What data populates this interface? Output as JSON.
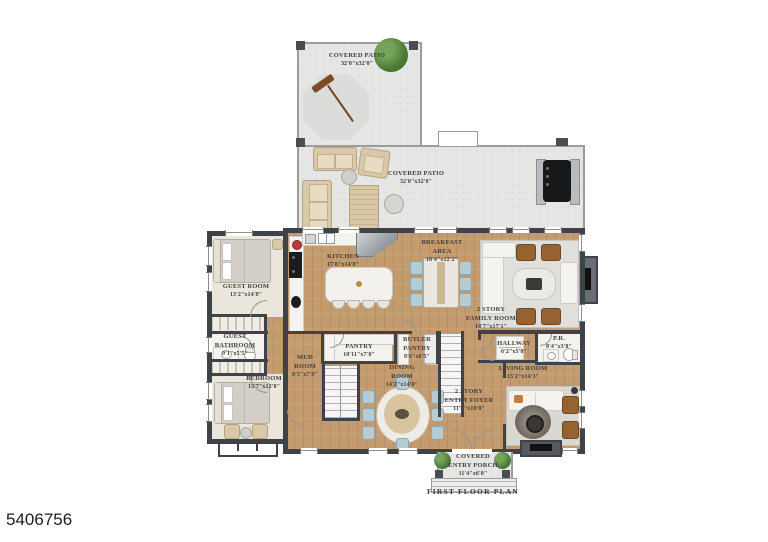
{
  "page": {
    "listing_id": "5406756",
    "caption": "FIRST FLOOR PLAN"
  },
  "colors": {
    "wall": "#3f4347",
    "wood_floor": "#c49b6e",
    "patio_concrete": "#e6e6e4",
    "plant_green": "#4e7b38"
  },
  "rooms": {
    "patio_upper": {
      "name": "COVERED PATIO",
      "dims": "32'0\"x32'0\""
    },
    "patio_lower": {
      "name": "COVERED PATIO",
      "dims": "32'0\"x32'0\""
    },
    "kitchen": {
      "name": "KITCHEN",
      "dims": "17'8\"x14'8\""
    },
    "breakfast": {
      "name": "BREAKFAST AREA",
      "dims": "18'4\"x12'2\""
    },
    "family": {
      "name": "2 STORY\nFAMILY ROOM",
      "dims": "14'7\"x17'1\""
    },
    "guest_room": {
      "name": "GUEST ROOM",
      "dims": "13'2\"x14'8\""
    },
    "guest_bath": {
      "name": "GUEST\nBATHROOM",
      "dims": "9'1\"x5'5\""
    },
    "bedroom": {
      "name": "BEDROOM",
      "dims": "13'7\"x12'8\""
    },
    "mud_room": {
      "name": "MUD ROOM",
      "dims": "8'5\"x7'9\""
    },
    "pantry": {
      "name": "PANTRY",
      "dims": "10'11\"x7'0\""
    },
    "butler": {
      "name": "BUTLER\nPANTRY",
      "dims": "8'6\"x6'5\""
    },
    "dining": {
      "name": "DINING ROOM",
      "dims": "14'2\"x14'0\""
    },
    "hallway": {
      "name": "HALLWAY",
      "dims": "6'2\"x5'8\""
    },
    "pr": {
      "name": "P.R.",
      "dims": "8'4\"x3'8\""
    },
    "living": {
      "name": "LIVING ROOM",
      "dims": "15'2\"x14'3\""
    },
    "foyer": {
      "name": "2 STORY\nENTRY FOYER",
      "dims": "11'4\"x19'8\""
    },
    "porch": {
      "name": "COVERED\nENTRY PORCH",
      "dims": "11'4\"x6'0\""
    }
  }
}
